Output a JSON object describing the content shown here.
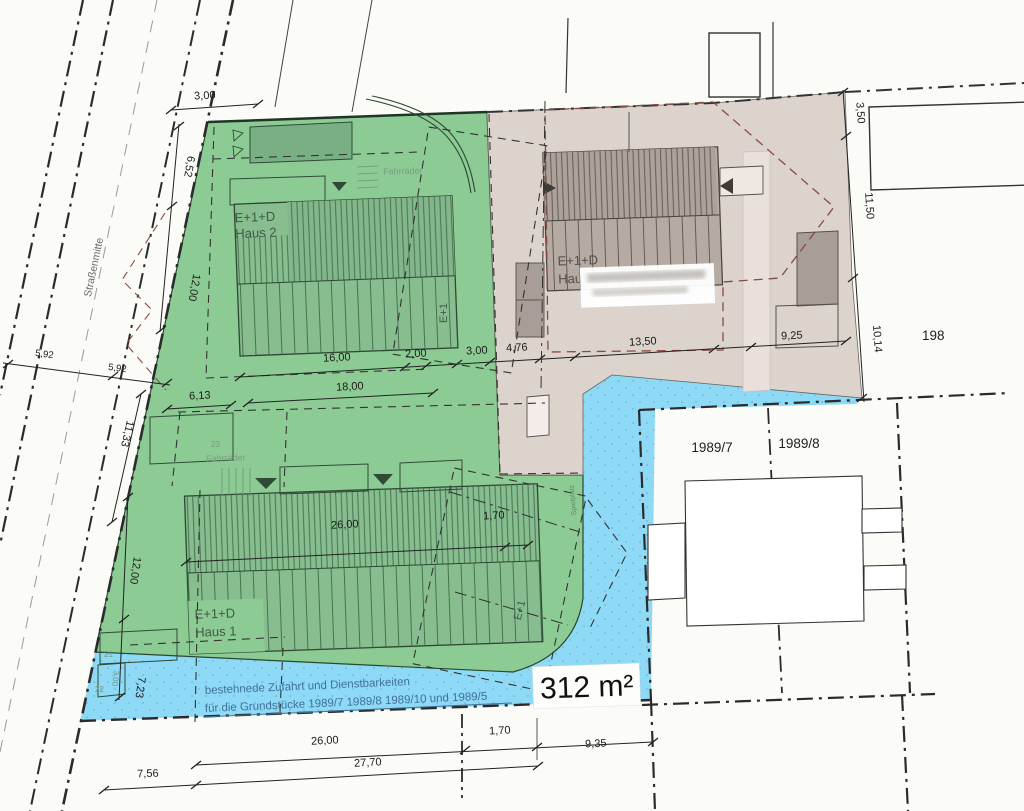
{
  "plan": {
    "title": "Lageplan",
    "area_label": "312 m²",
    "street": {
      "centerline_label": "Straßenmitte"
    },
    "parcels": {
      "p7": "1989/7",
      "p8": "1989/8",
      "p198": "198"
    },
    "buildings": {
      "haus2": {
        "line1": "E+1+D",
        "line2": "Haus 2"
      },
      "haus1": {
        "line1": "E+1+D",
        "line2": "Haus 1"
      },
      "haus3": {
        "line1": "E+1+D",
        "line2": "Hau"
      },
      "e1_haus2": "E+1",
      "e1_haus1": "E+1"
    },
    "labels": {
      "fahrraeder1": "Fahrräder",
      "fahrraeder2": "Fahrräder",
      "spielplatz": "Spielplatz",
      "n21": "21",
      "n22": "22",
      "n23": "23",
      "note1": "bestehnede Zufahrt und Dienstbarkeiten",
      "note2": "für die Grundstücke  1989/7 1989/8  1989/10 und 1989/5"
    },
    "dims": {
      "top3": "3,00",
      "h652": "6,52",
      "v12a": "12,00",
      "s592a": "5,92",
      "s592b": "5,92",
      "v1133": "11,33",
      "v12b": "12,00",
      "v723": "7,23",
      "v300": "3,00",
      "c16": "16,00",
      "c2": "2,00",
      "c3": "3,00",
      "c476": "4,76",
      "c1350": "13,50",
      "c925": "9,25",
      "c613": "6,13",
      "c18": "18,00",
      "i26": "26,00",
      "i170": "1,70",
      "r350": "3,50",
      "r1150": "11,50",
      "r1014": "10,14",
      "b26": "26,00",
      "b170": "1,70",
      "b935": "9,35",
      "b2770": "27,70",
      "b756": "7,56"
    },
    "colors": {
      "green_parcel": "#8ccb94",
      "green_building": "#87bd8f",
      "green_hatch": "#3e6b48",
      "gray_parcel": "#dbd3cc",
      "gray_building": "#b5aba3",
      "gray_hatch": "#5a534e",
      "blue_easement": "#8ed9f5",
      "red_dashed": "#8a4a42",
      "note_blue": "#41719b"
    }
  }
}
